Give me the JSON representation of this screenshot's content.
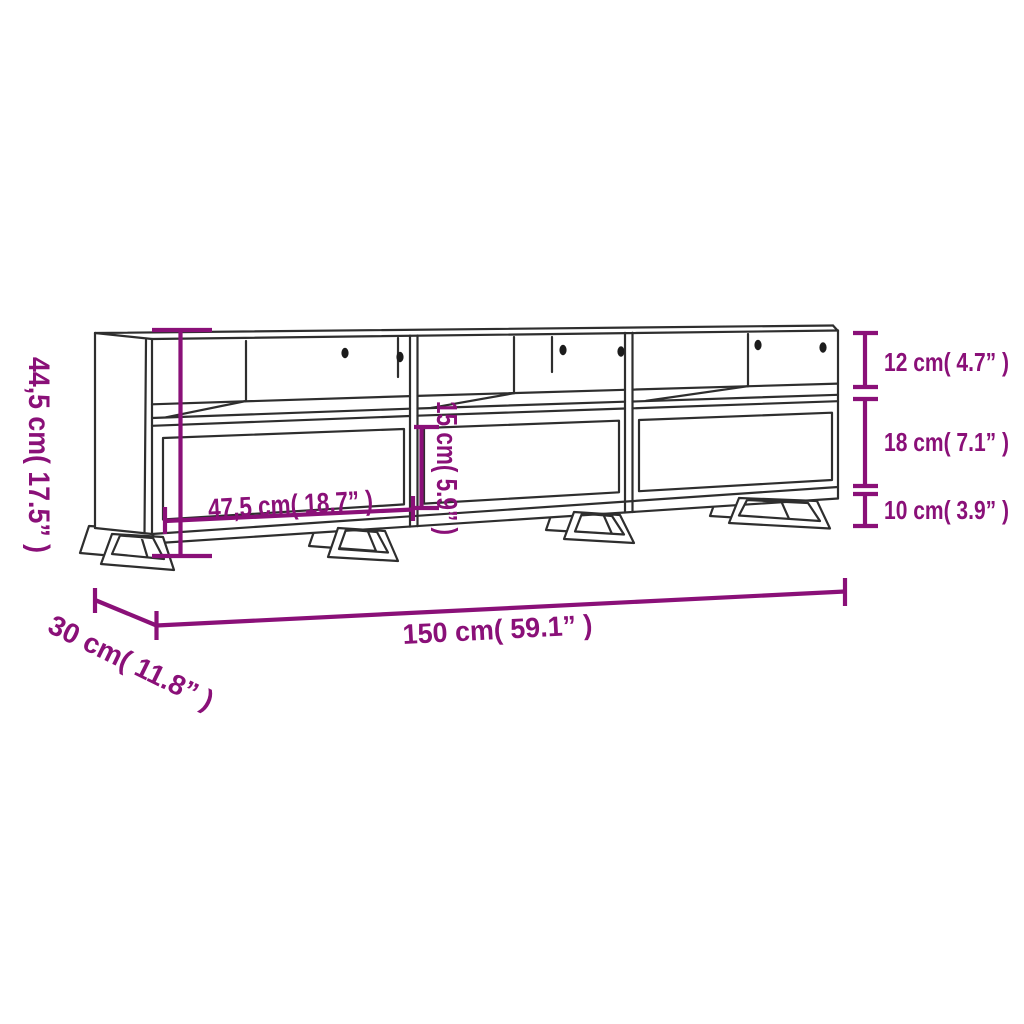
{
  "diagram": {
    "title": "TV stand dimension diagram",
    "colors": {
      "annotation": "#8a1078",
      "outline": "#2e2e2e",
      "background": "#ffffff"
    },
    "labels": {
      "overall_height": "44,5 cm( 17.5” )",
      "overall_width": "150 cm( 59.1” )",
      "overall_depth": "30 cm( 11.8” )",
      "compartment_width": "47,5 cm( 18.7” )",
      "compartment_height": "15 cm( 5.9” )",
      "top_shelf_height": "12 cm( 4.7” )",
      "drawer_front_height": "18 cm( 7.1” )",
      "leg_height": "10 cm( 3.9” )"
    }
  }
}
